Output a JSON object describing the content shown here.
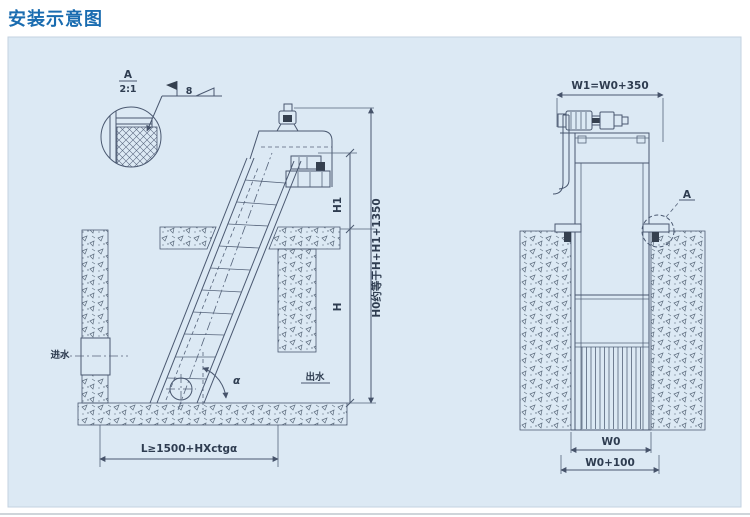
{
  "page": {
    "title": "安装示意图",
    "accent_color": "#1a6cb0",
    "panel_bg": "#dce9f4"
  },
  "left_view": {
    "detail_callout": {
      "label": "A",
      "scale": "2:1"
    },
    "weld_size": "8",
    "dims": {
      "h1": "H1",
      "h0": "H0约等于H+H1+1350",
      "h": "H",
      "length": "L≥1500+HXctgα"
    },
    "labels": {
      "inlet": "进水",
      "outlet": "出水",
      "angle": "α"
    }
  },
  "right_view": {
    "dims": {
      "w1": "W1=W0+350",
      "w0": "W0",
      "w0_plus": "W0+100"
    },
    "detail_ref": "A"
  }
}
